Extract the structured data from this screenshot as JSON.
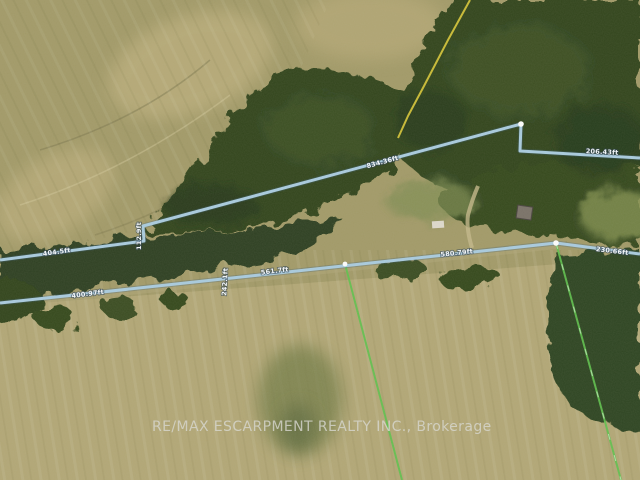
{
  "map": {
    "type": "satellite-aerial-photo",
    "watermark": "RE/MAX ESCARPMENT REALTY INC., Brokerage",
    "colors": {
      "boundary_line_blue": "#a9cbde",
      "boundary_line_shadow": "#3e6076",
      "survey_line_green": "#5fc14d",
      "trail_line_yellow": "#d9c838",
      "vertex_dot_white": "#fdfdfd",
      "field_tan": "#a29a68",
      "field_light_tan": "#c6b785",
      "forest_dark_green": "#31451f",
      "watermark_gray": "#d9d9d2"
    },
    "boundary_labels": {
      "upper_left": "404.5ft",
      "upper_jog": "112.9ft",
      "upper_mid": "834.36ft",
      "upper_right": "206.43ft",
      "lower_left": "400.97ft",
      "lower_cross": "242.1ft",
      "lower_mid_left": "561.7ft",
      "lower_mid_right": "580.79ft",
      "lower_right": "230.66ft"
    }
  }
}
